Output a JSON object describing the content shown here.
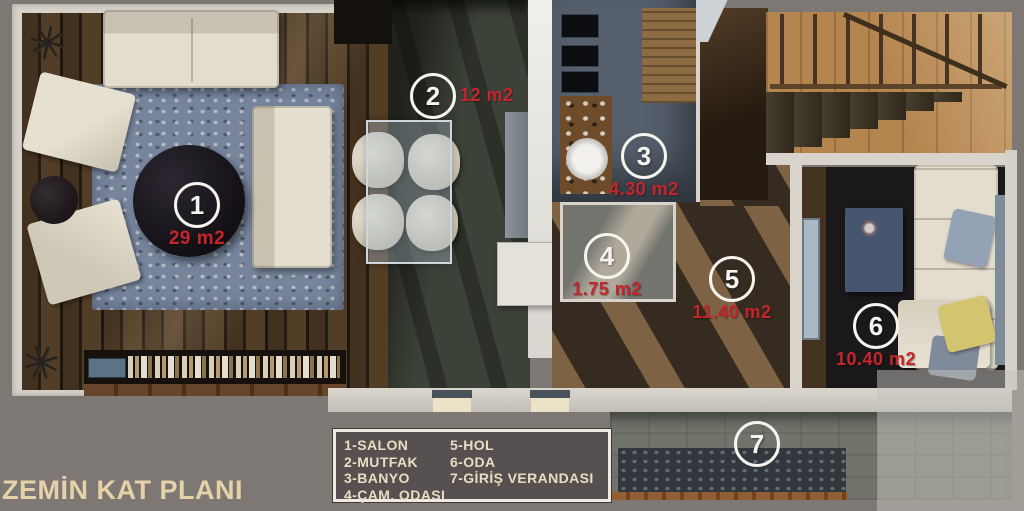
{
  "title": "ZEMİN KAT PLANI",
  "legend": {
    "column1": [
      {
        "label": "1-SALON"
      },
      {
        "label": "2-MUTFAK"
      },
      {
        "label": "3-BANYO"
      },
      {
        "label": "4-ÇAM. ODASI"
      }
    ],
    "column2": [
      {
        "label": "5-HOL"
      },
      {
        "label": "6-ODA"
      },
      {
        "label": "7-GİRİŞ VERANDASI"
      }
    ]
  },
  "rooms": [
    {
      "number": "1",
      "name": "SALON",
      "area": "29 m2"
    },
    {
      "number": "2",
      "name": "MUTFAK",
      "area": "12 m2"
    },
    {
      "number": "3",
      "name": "BANYO",
      "area": "4.30 m2"
    },
    {
      "number": "4",
      "name": "ÇAM. ODASI",
      "area": "1.75 m2"
    },
    {
      "number": "5",
      "name": "HOL",
      "area": "11.40 m2"
    },
    {
      "number": "6",
      "name": "ODA",
      "area": "10.40 m2"
    },
    {
      "number": "7",
      "name": "GİRİŞ VERANDASI",
      "area": ""
    }
  ],
  "icons": {
    "plant_glyph": "✳"
  },
  "colors": {
    "area_label": "#c5252b",
    "marker_ring": "#f6f4ee",
    "legend_text": "#e8ddc2",
    "legend_background": "#565150",
    "title_text": "#e6d2a8",
    "page_background": "#7d7873"
  }
}
